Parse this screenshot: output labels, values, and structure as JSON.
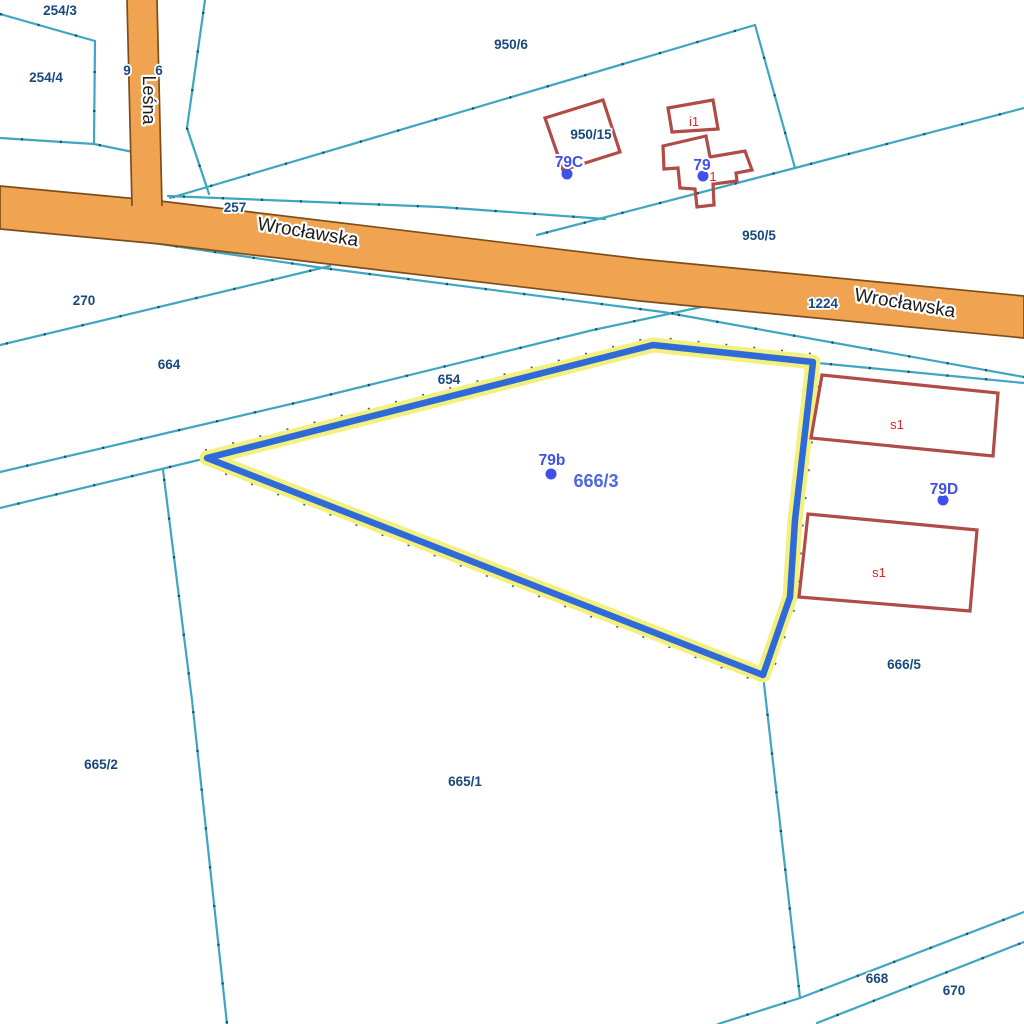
{
  "map": {
    "title": "cadastral-map",
    "background": "#ffffff",
    "colors": {
      "boundary": "#3ea5c2",
      "boundary_tick": "#123a50",
      "road_fill": "#f0a351",
      "road_border": "#7d4e1a",
      "road_text": "#1c1c1c",
      "building": "#b04b48",
      "building_text": "#e02424",
      "parcel_text": "#17497d",
      "address_text": "#4150e8",
      "selected_text": "#4e68e2",
      "highlight_blue": "#2f6bd8",
      "highlight_yellow": "#f4f07e"
    },
    "boundary_lines": [
      {
        "points": [
          [
            0,
            14
          ],
          [
            95,
            41
          ]
        ]
      },
      {
        "points": [
          [
            95,
            41
          ],
          [
            94,
            144
          ]
        ]
      },
      {
        "points": [
          [
            0,
            138
          ],
          [
            94,
            144
          ],
          [
            133,
            152
          ]
        ]
      },
      {
        "points": [
          [
            205,
            0
          ],
          [
            187,
            128
          ],
          [
            209,
            194
          ]
        ]
      },
      {
        "points": [
          [
            170,
            198
          ],
          [
            755,
            25
          ]
        ]
      },
      {
        "points": [
          [
            755,
            25
          ],
          [
            795,
            168
          ]
        ]
      },
      {
        "points": [
          [
            1024,
            108
          ],
          [
            795,
            168
          ],
          [
            537,
            235
          ]
        ]
      },
      {
        "points": [
          [
            168,
            196
          ],
          [
            440,
            207
          ],
          [
            605,
            219
          ]
        ]
      },
      {
        "points": [
          [
            0,
            345
          ],
          [
            330,
            266
          ]
        ]
      },
      {
        "points": [
          [
            140,
            241
          ],
          [
            323,
            268
          ],
          [
            663,
            312
          ],
          [
            1024,
            377
          ]
        ]
      },
      {
        "points": [
          [
            0,
            472
          ],
          [
            308,
            400
          ],
          [
            593,
            330
          ],
          [
            720,
            303
          ]
        ]
      },
      {
        "points": [
          [
            0,
            508
          ],
          [
            207,
            458
          ]
        ]
      },
      {
        "points": [
          [
            163,
            470
          ],
          [
            192,
            700
          ],
          [
            227,
            1024
          ]
        ]
      },
      {
        "points": [
          [
            763,
            675
          ],
          [
            800,
            998
          ]
        ]
      },
      {
        "points": [
          [
            718,
            1024
          ],
          [
            800,
            998
          ],
          [
            1024,
            912
          ]
        ]
      },
      {
        "points": [
          [
            817,
            1023
          ],
          [
            1024,
            942
          ]
        ]
      },
      {
        "points": [
          [
            818,
            363
          ],
          [
            1024,
            383
          ]
        ]
      }
    ],
    "roads": {
      "wroclawska": {
        "name": "Wrocławska",
        "polygon": [
          [
            0,
            186
          ],
          [
            160,
            201
          ],
          [
            640,
            259
          ],
          [
            1024,
            296
          ],
          [
            1024,
            338
          ],
          [
            640,
            301
          ],
          [
            160,
            244
          ],
          [
            0,
            229
          ]
        ],
        "labels": [
          {
            "text": "Wrocławska",
            "x": 307,
            "y": 238,
            "rotation": 9.5
          },
          {
            "text": "Wrocławska",
            "x": 904,
            "y": 309,
            "rotation": 9.5
          }
        ]
      },
      "lesna": {
        "name": "Leśna",
        "polygon": [
          [
            127,
            0
          ],
          [
            157,
            0
          ],
          [
            162,
            208
          ],
          [
            132,
            208
          ]
        ],
        "borders": [
          [
            [
              127,
              0
            ],
            [
              132,
              206
            ]
          ],
          [
            [
              157,
              0
            ],
            [
              162,
              206
            ]
          ]
        ],
        "label": {
          "text": "Leśna",
          "x": 143,
          "y": 100,
          "rotation": 90
        }
      }
    },
    "highlighted_parcel": {
      "label": "666/3",
      "label_pos": {
        "x": 596,
        "y": 487
      },
      "points": [
        [
          207,
          458
        ],
        [
          653,
          345
        ],
        [
          813,
          362
        ],
        [
          795,
          520
        ],
        [
          790,
          597
        ],
        [
          763,
          675
        ]
      ]
    },
    "buildings": [
      {
        "path": "M545,118 L603,100 L620,152 L563,170 Z"
      },
      {
        "path": "M668,108 L713,100 L718,129 L672,132 Z"
      },
      {
        "path": "M663,146 L706,136 L710,157 L745,151 L752,170 L736,173 L737,181 L713,184 L714,205 L697,207 L695,189 L680,188 L678,168 L664,169 Z"
      },
      {
        "path": "M822,375 L998,393 L993,456 L811,438 Z"
      },
      {
        "path": "M808,514 L977,530 L970,611 L799,597 Z"
      }
    ],
    "parcel_labels": [
      {
        "text": "254/3",
        "x": 60,
        "y": 15
      },
      {
        "text": "254/4",
        "x": 46,
        "y": 82
      },
      {
        "text": "9",
        "x": 127,
        "y": 75
      },
      {
        "text": "6",
        "x": 159,
        "y": 75
      },
      {
        "text": "950/6",
        "x": 511,
        "y": 49
      },
      {
        "text": "950/15",
        "x": 591,
        "y": 139
      },
      {
        "text": "950/5",
        "x": 759,
        "y": 240
      },
      {
        "text": "257",
        "x": 235,
        "y": 212
      },
      {
        "text": "270",
        "x": 84,
        "y": 305
      },
      {
        "text": "664",
        "x": 169,
        "y": 369
      },
      {
        "text": "654",
        "x": 449,
        "y": 384
      },
      {
        "text": "1224",
        "x": 823,
        "y": 308
      },
      {
        "text": "666/5",
        "x": 904,
        "y": 669
      },
      {
        "text": "665/2",
        "x": 101,
        "y": 769
      },
      {
        "text": "665/1",
        "x": 465,
        "y": 786
      },
      {
        "text": "668",
        "x": 877,
        "y": 983
      },
      {
        "text": "670",
        "x": 954,
        "y": 995
      }
    ],
    "address_labels": [
      {
        "text": "79C",
        "x": 569,
        "y": 167,
        "dot": {
          "x": 567,
          "y": 174
        }
      },
      {
        "text": "79",
        "x": 702,
        "y": 170,
        "dot": {
          "x": 703,
          "y": 176
        }
      },
      {
        "text": "79b",
        "x": 552,
        "y": 465,
        "dot": {
          "x": 551,
          "y": 474
        }
      },
      {
        "text": "79D",
        "x": 944,
        "y": 494,
        "dot": {
          "x": 943,
          "y": 500
        }
      }
    ],
    "building_labels": [
      {
        "text": "i1",
        "x": 694,
        "y": 126
      },
      {
        "text": "1",
        "x": 713,
        "y": 181
      },
      {
        "text": "s1",
        "x": 897,
        "y": 429
      },
      {
        "text": "s1",
        "x": 879,
        "y": 577
      }
    ]
  }
}
